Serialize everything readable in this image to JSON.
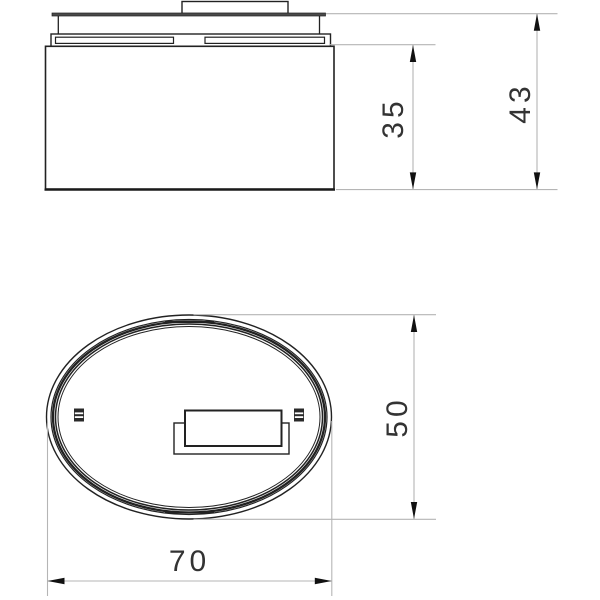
{
  "drawing": {
    "type": "technical-dimension-drawing",
    "colors": {
      "background": "#ffffff",
      "outline": "#222222",
      "dimension_line": "#b5b5b5",
      "arrow": "#111111",
      "text": "#333333"
    },
    "front_view": {
      "dim_body_height": "35",
      "dim_total_height": "43"
    },
    "plan_view": {
      "dim_width": "50",
      "dim_length": "70"
    }
  }
}
